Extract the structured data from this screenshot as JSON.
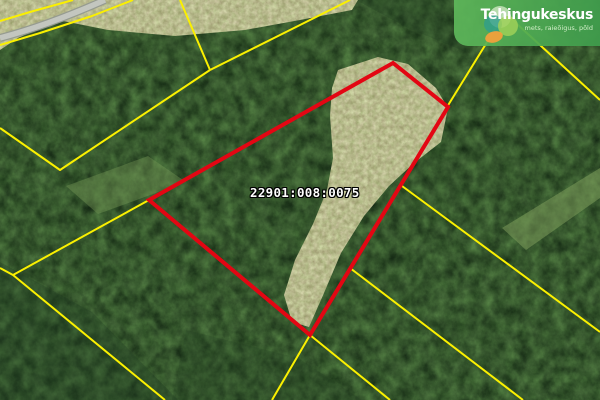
{
  "map": {
    "parcel": {
      "cadastral_number": "22901:008:0075",
      "outline_color": "#e30613",
      "outline_width": 4,
      "points": [
        [
          149,
          200
        ],
        [
          393,
          63
        ],
        [
          448,
          107
        ],
        [
          310,
          335
        ]
      ]
    },
    "boundaries": {
      "color": "#fbf000",
      "width": 2,
      "lines": [
        [
          [
            73,
            0
          ],
          [
            30,
            12
          ],
          [
            0,
            21
          ]
        ],
        [
          [
            133,
            0
          ],
          [
            92,
            16
          ],
          [
            40,
            33
          ],
          [
            0,
            45
          ]
        ],
        [
          [
            180,
            0
          ],
          [
            210,
            70
          ]
        ],
        [
          [
            350,
            0
          ],
          [
            280,
            35
          ],
          [
            210,
            70
          ]
        ],
        [
          [
            210,
            70
          ],
          [
            60,
            170
          ],
          [
            0,
            128
          ]
        ],
        [
          [
            149,
            200
          ],
          [
            13,
            275
          ],
          [
            0,
            268
          ]
        ],
        [
          [
            13,
            275
          ],
          [
            165,
            400
          ]
        ],
        [
          [
            447,
            107
          ],
          [
            505,
            13
          ],
          [
            600,
            100
          ]
        ],
        [
          [
            402,
            186
          ],
          [
            600,
            332
          ]
        ],
        [
          [
            350,
            268
          ],
          [
            523,
            400
          ]
        ],
        [
          [
            310,
            335
          ],
          [
            390,
            400
          ]
        ],
        [
          [
            310,
            335
          ],
          [
            272,
            400
          ]
        ]
      ]
    },
    "road": {
      "casing_color": "#969b90",
      "fill_color": "#c3c6bf",
      "casing_width": 8,
      "fill_width": 5.5,
      "path": "M105,0 C78,12 38,28 0,38"
    },
    "terrain": {
      "forest_base": "#3d5c36",
      "clearing_polygons": [
        [
          [
            0,
            0
          ],
          [
            358,
            0
          ],
          [
            352,
            10
          ],
          [
            300,
            20
          ],
          [
            245,
            30
          ],
          [
            175,
            36
          ],
          [
            108,
            30
          ],
          [
            58,
            20
          ],
          [
            18,
            38
          ],
          [
            0,
            50
          ]
        ],
        [
          [
            338,
            70
          ],
          [
            378,
            57
          ],
          [
            408,
            64
          ],
          [
            436,
            88
          ],
          [
            448,
            108
          ],
          [
            441,
            142
          ],
          [
            414,
            163
          ],
          [
            389,
            186
          ],
          [
            364,
            216
          ],
          [
            341,
            253
          ],
          [
            324,
            293
          ],
          [
            309,
            327
          ],
          [
            292,
            322
          ],
          [
            284,
            295
          ],
          [
            295,
            260
          ],
          [
            313,
            224
          ],
          [
            327,
            190
          ],
          [
            333,
            158
          ],
          [
            330,
            116
          ],
          [
            332,
            88
          ]
        ]
      ],
      "dark_patches": [
        {
          "points": [
            [
              0,
              262
            ],
            [
              92,
              312
            ],
            [
              178,
              400
            ],
            [
              0,
              400
            ]
          ],
          "color": "#203c21",
          "opacity": 0.32
        },
        {
          "points": [
            [
              356,
              0
            ],
            [
              460,
              0
            ],
            [
              466,
              52
            ],
            [
              408,
              28
            ]
          ],
          "color": "#203c21",
          "opacity": 0.28
        },
        {
          "points": [
            [
              186,
              330
            ],
            [
              298,
              358
            ],
            [
              362,
              400
            ],
            [
              172,
              400
            ]
          ],
          "color": "#203c21",
          "opacity": 0.22
        }
      ],
      "light_patches": [
        {
          "points": [
            [
              502,
              228
            ],
            [
              600,
              168
            ],
            [
              600,
              198
            ],
            [
              526,
              250
            ]
          ],
          "color": "#8fae66",
          "opacity": 0.45
        },
        {
          "points": [
            [
              66,
              186
            ],
            [
              148,
              156
            ],
            [
              186,
              182
            ],
            [
              98,
              214
            ]
          ],
          "color": "#7da15c",
          "opacity": 0.38
        }
      ]
    }
  },
  "logo": {
    "title": "Tehingukeskus",
    "tagline": "mets, raieõigus, põld",
    "colors": {
      "banner_left": "#5fb95b",
      "banner_right": "#3f9c4c",
      "title": "#ffffff",
      "pale_circle": "#d8eccb",
      "teal_circle": "#2f9e8c",
      "green_circle": "#9ed058",
      "orange_blob": "#f1a03c"
    }
  }
}
